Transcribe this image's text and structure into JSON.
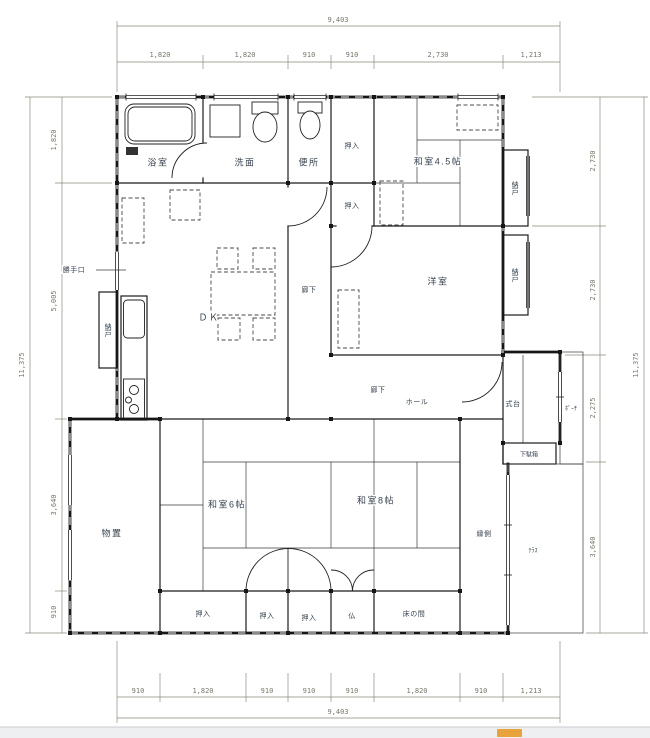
{
  "page": {
    "background": "#ffffff",
    "statusbar": {
      "color": "#edeff0",
      "border": "#c9cdd0",
      "accent_color": "#e8a33d"
    }
  },
  "colors": {
    "wall_line": "#161616",
    "label_text": "#38434f",
    "dimension_text": "#77776a"
  },
  "dimensions": {
    "top": {
      "overall": "9,403",
      "segments": [
        "1,820",
        "1,820",
        "910",
        "910",
        "2,730",
        "1,213"
      ]
    },
    "bottom": {
      "overall": "9,403",
      "segments": [
        "910",
        "1,820",
        "910",
        "910",
        "910",
        "1,820",
        "910",
        "1,213"
      ]
    },
    "left": {
      "overall": "11,375",
      "segments": [
        "1,820",
        "5,005",
        "3,640",
        "910"
      ]
    },
    "right": {
      "overall": "11,375",
      "segments": [
        "2,730",
        "2,730",
        "2,275",
        "3,640"
      ]
    }
  },
  "rooms": {
    "bathroom": "浴室",
    "washroom": "洗面",
    "toilet": "便所",
    "oshiire": "押入",
    "washitsu_45": "和室4.5帖",
    "nando": "納戸",
    "katteguchi": "勝手口",
    "dk": "ＤＫ",
    "rouka": "廊下",
    "youshitsu": "洋室",
    "hall": "ホール",
    "shikidai": "式台",
    "genkan": "玄関",
    "porch": "ﾎﾟｰﾁ",
    "getabako": "下駄箱",
    "monooki": "物置",
    "washitsu_6": "和室6帖",
    "washitsu_8": "和室8帖",
    "engawa": "縁側",
    "terrace": "ﾃﾗｽ",
    "butsuma": "仏",
    "tokonoma": "床の間"
  }
}
